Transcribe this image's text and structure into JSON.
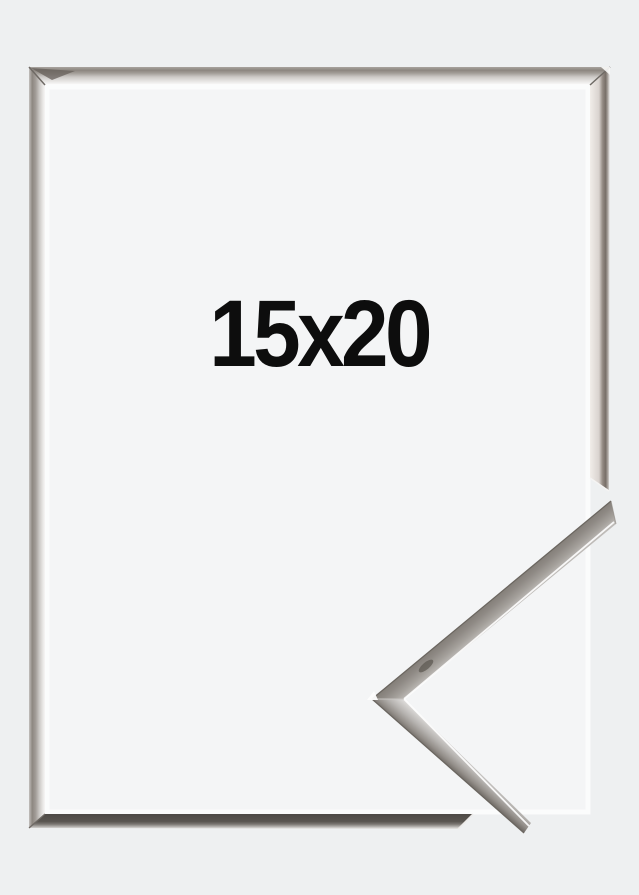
{
  "product": {
    "size_label": "15x20",
    "label_color": "#0d0d0d",
    "frame_finish": "silver",
    "colors": {
      "page_background": "#eef0f1",
      "backing_inside_frame": "#f4f5f6",
      "inner_edge_glow": "#fdfdfd",
      "silver_highlight": "#f7f6f5",
      "silver_mid": "#a29d98",
      "silver_dark_edge": "#6b6660",
      "bottom_rail_shadow": "#55514c"
    }
  }
}
